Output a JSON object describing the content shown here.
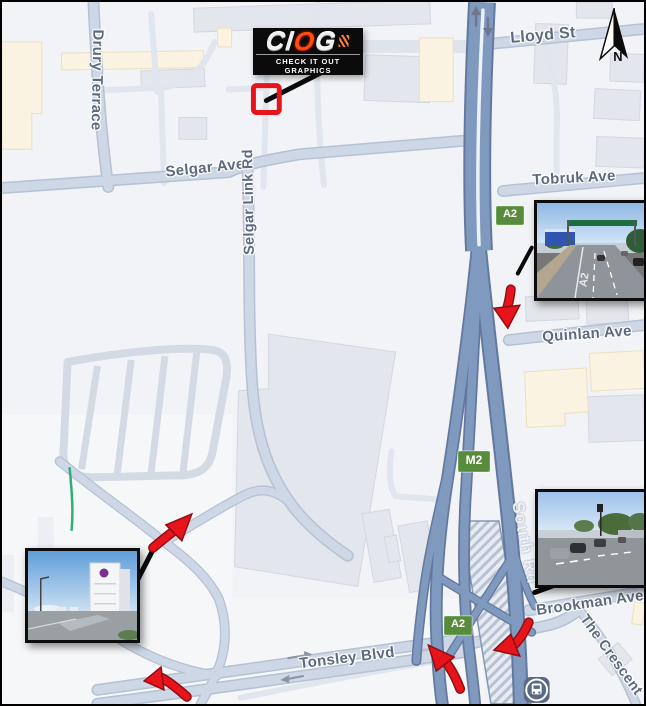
{
  "map": {
    "streets": {
      "lloyd_st": "Lloyd St",
      "tobruk_ave": "Tobruk Ave",
      "quinlan_ave": "Quinlan Ave",
      "selgar_ave": "Selgar Ave",
      "selgar_link_rd": "Selgar Link Rd",
      "drury_terrace": "Drury Terrace",
      "south_rd": "South Rd",
      "brookman_ave": "Brookman Ave",
      "the_crescent": "The Crescent",
      "tonsley_blvd": "Tonsley Blvd"
    },
    "route_badges": {
      "a2_north": "A2",
      "m2": "M2",
      "a2_south": "A2"
    },
    "compass": {
      "label": "N"
    }
  },
  "logo": {
    "letters": [
      "C",
      "I",
      "O",
      "G"
    ],
    "caption": "CHECK IT OUT GRAPHICS"
  },
  "insets": {
    "north_east": {
      "road_marking": "A2"
    }
  },
  "colors": {
    "accent_red": "#e8141b",
    "badge_green": "#588c3c",
    "motorway": "#8099bf",
    "arterial": "#cdd7e5",
    "minor_road": "#e0e5ee",
    "building": "#e3e6ec",
    "building_alt": "#faf3e1",
    "label_text": "#5c6a7e",
    "logo_orange": "#ff4d12"
  }
}
